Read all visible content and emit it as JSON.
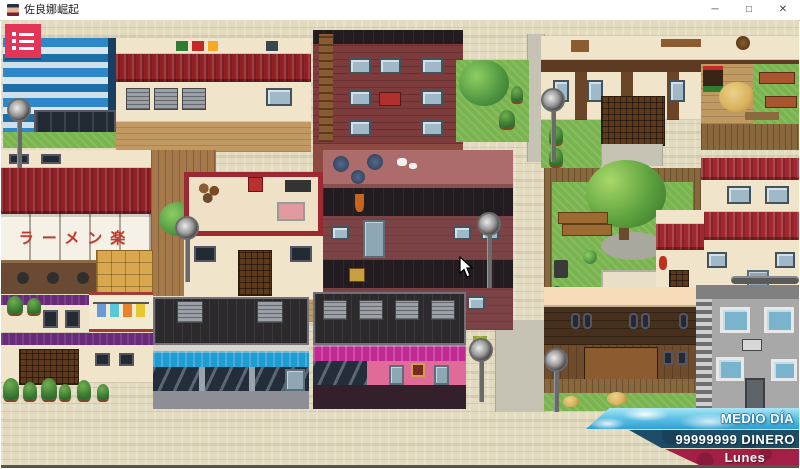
{
  "window": {
    "title": "佐良娜崛起",
    "controls": {
      "minimize": "─",
      "maximize": "□",
      "close": "✕"
    }
  },
  "hud": {
    "time_of_day": "MEDIO DÍA",
    "money": "99999999 DINERO",
    "weekday": "Lunes"
  },
  "map": {
    "ramen_sign": "ラーメン楽"
  },
  "icons": {
    "menu": "list-menu-icon",
    "minimize": "minimize-icon",
    "maximize": "maximize-icon",
    "close": "close-icon"
  },
  "colors": {
    "menu_button": "#e23558",
    "hud_money_bg": "#1d4c66",
    "hud_day_bg": "#a41f45",
    "hud_sky_bg": "#56b9e0",
    "ground": "#e3dbc0",
    "title_bar": "#ffffff"
  }
}
